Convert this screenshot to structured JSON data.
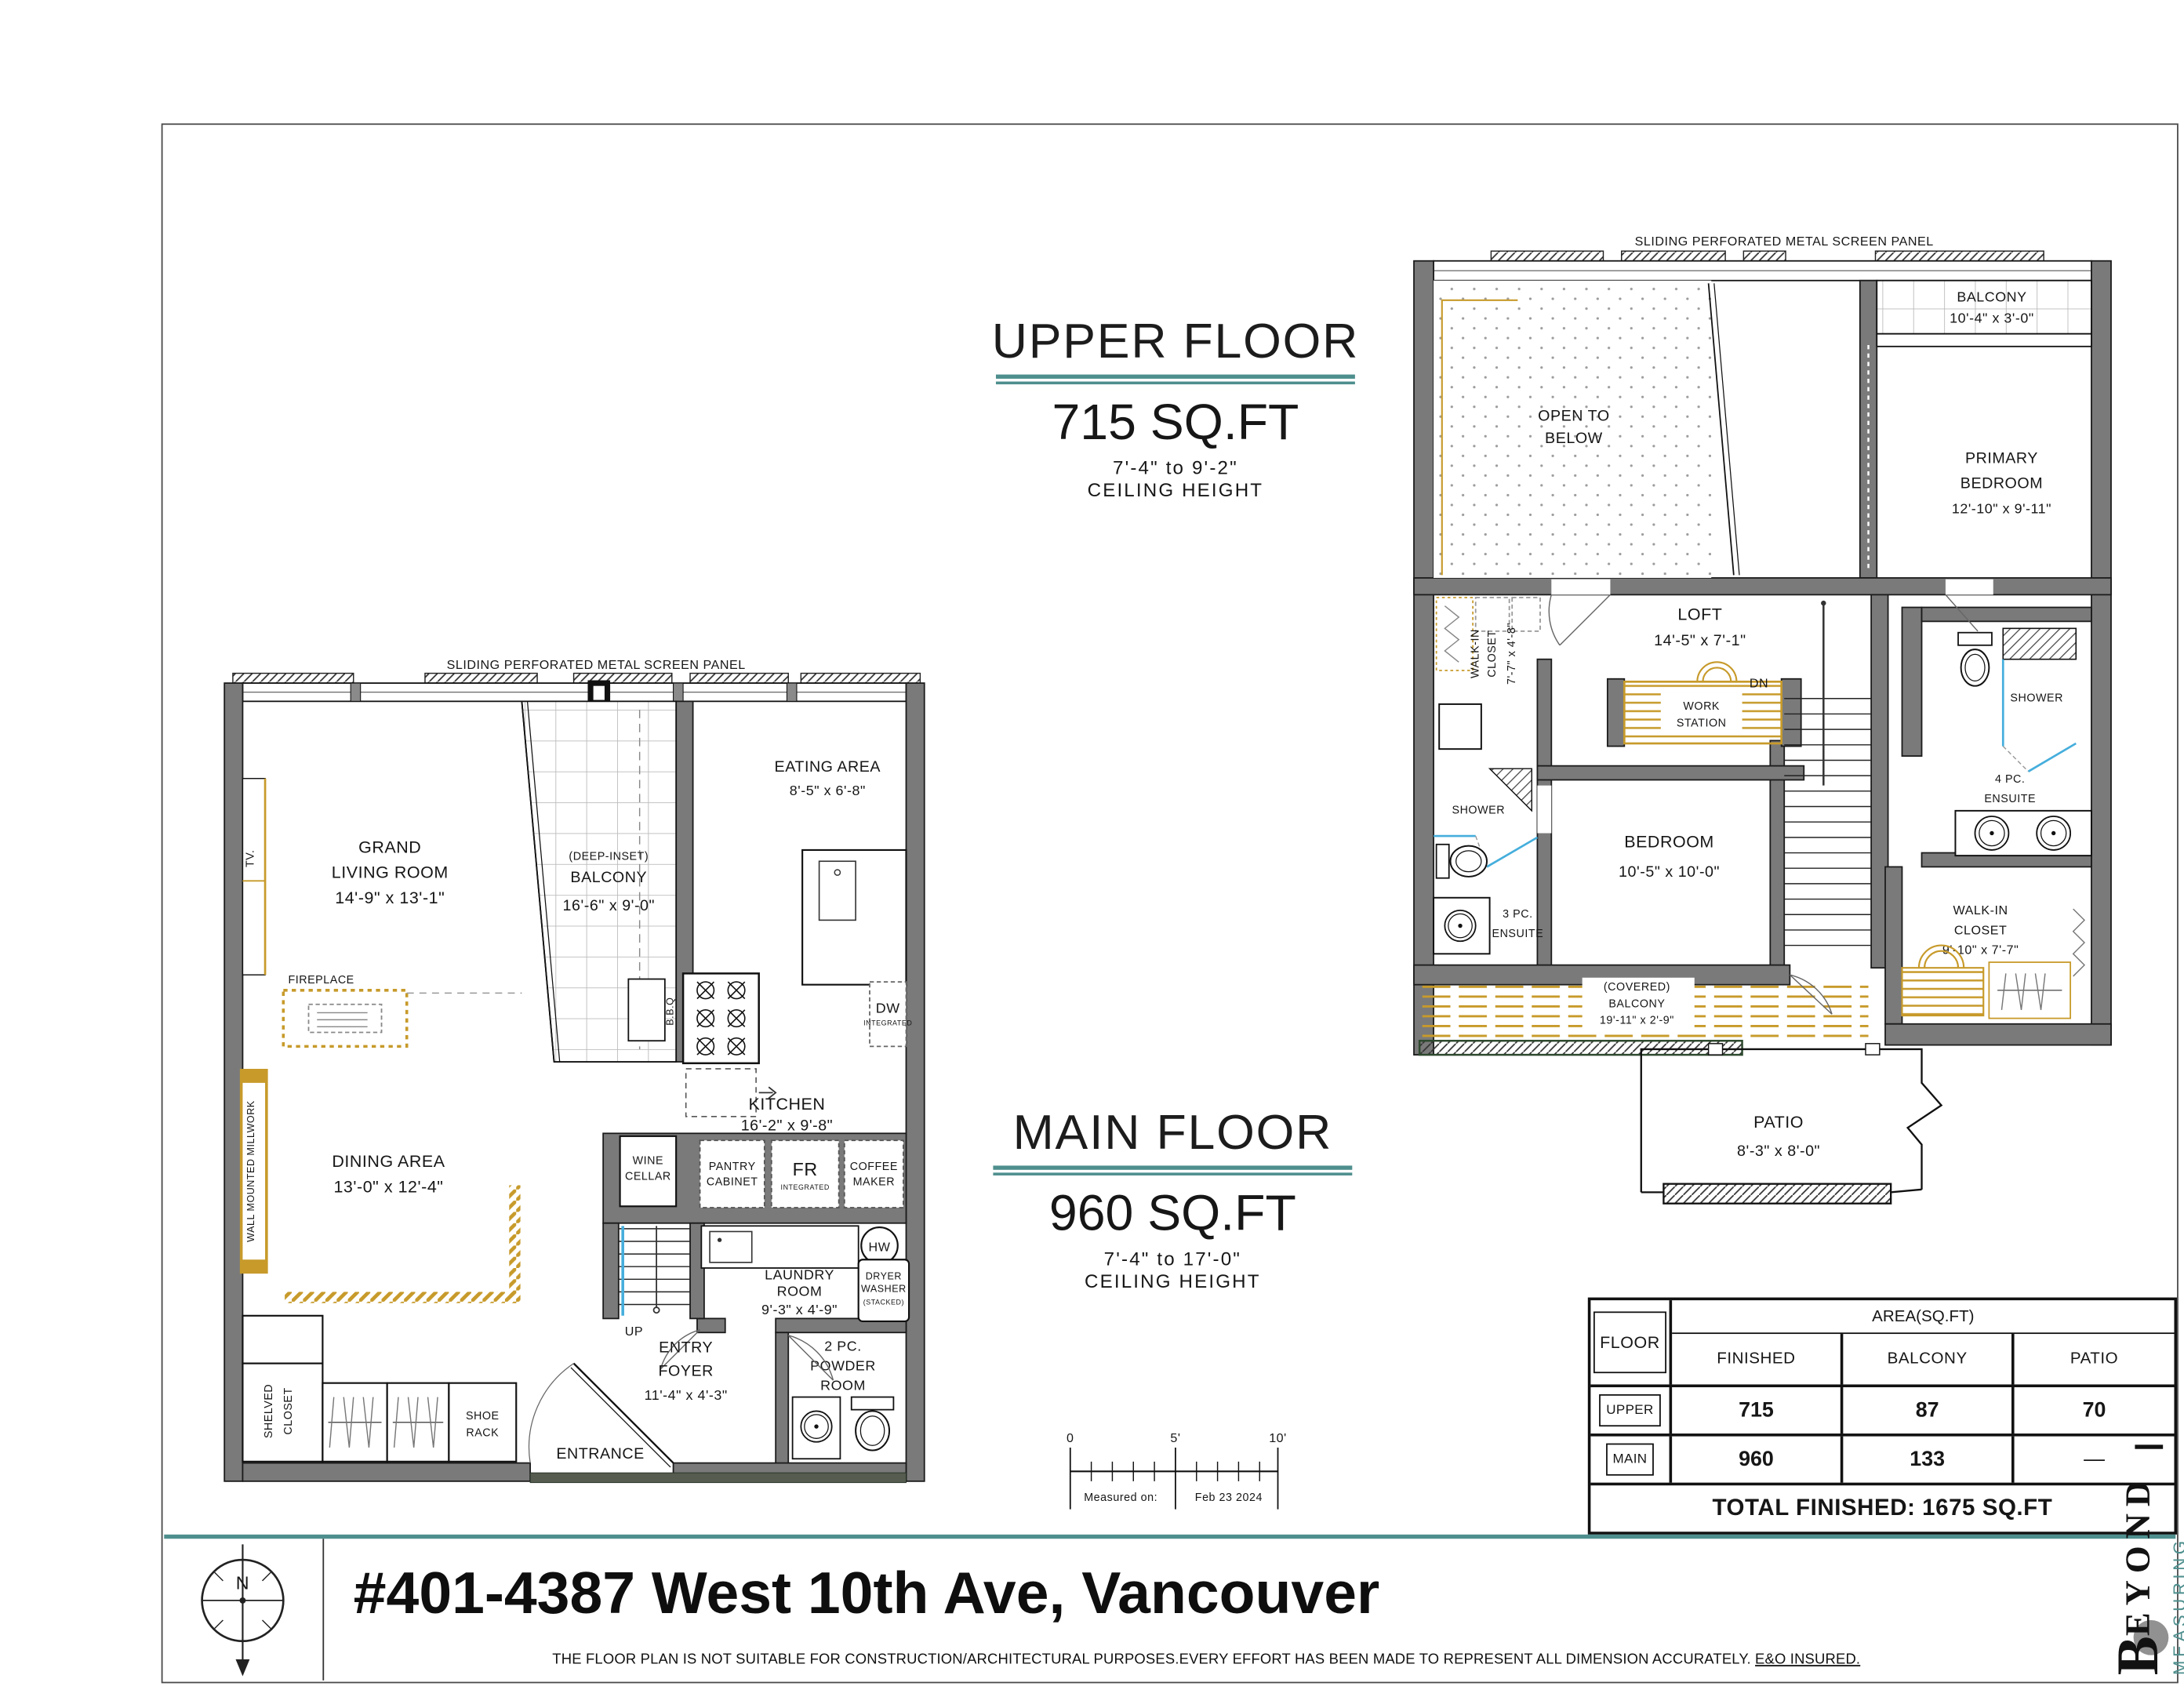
{
  "colors": {
    "teal": "#4E8F8E",
    "gold": "#C79A2A",
    "wall_gray": "#7A7A7A",
    "glass_blue": "#45AEDC"
  },
  "upper_floor": {
    "title": "UPPER FLOOR",
    "area": "715 SQ.FT",
    "ceiling_range": "7'-4\" to 9'-2\"",
    "ceiling_label": "CEILING HEIGHT",
    "screen_panel_label": "SLIDING PERFORATED  METAL SCREEN PANEL",
    "rooms": {
      "open_below": [
        "OPEN TO",
        "BELOW"
      ],
      "balcony": [
        "BALCONY",
        "10'-4\" x 3'-0\""
      ],
      "primary_bedroom": [
        "PRIMARY",
        "BEDROOM",
        "12'-10\" x 9'-11\""
      ],
      "walk_in_closet_left": [
        "WALK-IN",
        "CLOSET",
        "7'-7\" x 4'-8\""
      ],
      "loft": [
        "LOFT",
        "14'-5\" x 7'-1\""
      ],
      "work_station": [
        "WORK",
        "STATION"
      ],
      "stairs_dn": "DN",
      "shower_left": "SHOWER",
      "ensuite_3pc": [
        "3 PC.",
        "ENSUITE"
      ],
      "bedroom": [
        "BEDROOM",
        "10'-5\" x 10'-0\""
      ],
      "shower_right": "SHOWER",
      "ensuite_4pc": [
        "4 PC.",
        "ENSUITE"
      ],
      "walk_in_closet_right": [
        "WALK-IN",
        "CLOSET",
        "9'-10\" x 7'-7\""
      ],
      "covered_balcony": [
        "(COVERED)",
        "BALCONY",
        "19'-11\" x 2'-9\""
      ],
      "patio": [
        "PATIO",
        "8'-3\" x 8'-0\""
      ]
    }
  },
  "main_floor": {
    "title": "MAIN FLOOR",
    "area": "960 SQ.FT",
    "ceiling_range": "7'-4\" to 17'-0\"",
    "ceiling_label": "CEILING HEIGHT",
    "screen_panel_label": "SLIDING PERFORATED  METAL SCREEN PANEL",
    "rooms": {
      "grand_living": [
        "GRAND",
        "LIVING ROOM",
        "14'-9\" x 13'-1\""
      ],
      "balcony": [
        "(DEEP-INSET)",
        "BALCONY",
        "16'-6\" x 9'-0\""
      ],
      "eating_area": [
        "EATING AREA",
        "8'-5\" x 6'-8\""
      ],
      "kitchen": [
        "KITCHEN",
        "16'-2\" x 9'-8\""
      ],
      "dining_area": [
        "DINING AREA",
        "13'-0\" x 12'-4\""
      ],
      "laundry": [
        "LAUNDRY",
        "ROOM",
        "9'-3\" x 4'-9\""
      ],
      "entry_foyer": [
        "ENTRY",
        "FOYER",
        "11'-4\" x 4'-3\""
      ],
      "powder": [
        "2 PC.",
        "POWDER",
        "ROOM"
      ],
      "fireplace": "FIREPLACE",
      "tv": "TV.",
      "millwork": "WALL MOUNTED MILLWORK",
      "shelved_closet": [
        "SHELVED",
        "CLOSET"
      ],
      "shoe_rack": [
        "SHOE",
        "RACK"
      ],
      "wine_cellar": [
        "WINE",
        "CELLAR"
      ],
      "pantry": [
        "PANTRY",
        "CABINET"
      ],
      "fridge": {
        "label": "FR",
        "sub": "INTEGRATED"
      },
      "coffee": [
        "COFFEE",
        "MAKER"
      ],
      "dishwasher": {
        "label": "DW",
        "sub": "INTEGRATED"
      },
      "hot_water": "HW",
      "dryer": [
        "DRYER",
        "WASHER",
        "(STACKED)"
      ],
      "bbq": "B.B.Q",
      "stairs_up": "UP",
      "entrance": "ENTRANCE"
    }
  },
  "area_table": {
    "floor_header": "FLOOR",
    "area_header": "AREA(SQ.FT)",
    "columns": [
      "FINISHED",
      "BALCONY",
      "PATIO"
    ],
    "rows": [
      {
        "floor": "UPPER",
        "finished": "715",
        "balcony": "87",
        "patio": "70"
      },
      {
        "floor": "MAIN",
        "finished": "960",
        "balcony": "133",
        "patio": "—"
      }
    ],
    "total": "TOTAL FINISHED: 1675 SQ.FT"
  },
  "scale_bar": {
    "ticks": [
      "0",
      "5'",
      "10'"
    ],
    "measured_label": "Measured on:",
    "measured_date": "Feb 23 2024"
  },
  "footer": {
    "address": "#401-4387 West 10th Ave, Vancouver",
    "disclaimer": "THE  FLOOR PLAN  IS NOT SUITABLE FOR CONSTRUCTION/ARCHITECTURAL PURPOSES.EVERY EFFORT HAS BEEN MADE TO REPRESENT ALL DIMENSION ACCURATELY.",
    "disclaimer_underlined": "E&O INSURED.",
    "north": "N"
  },
  "branding": {
    "initial": "B",
    "rest": "EYOND",
    "sub": "MEASURING"
  }
}
